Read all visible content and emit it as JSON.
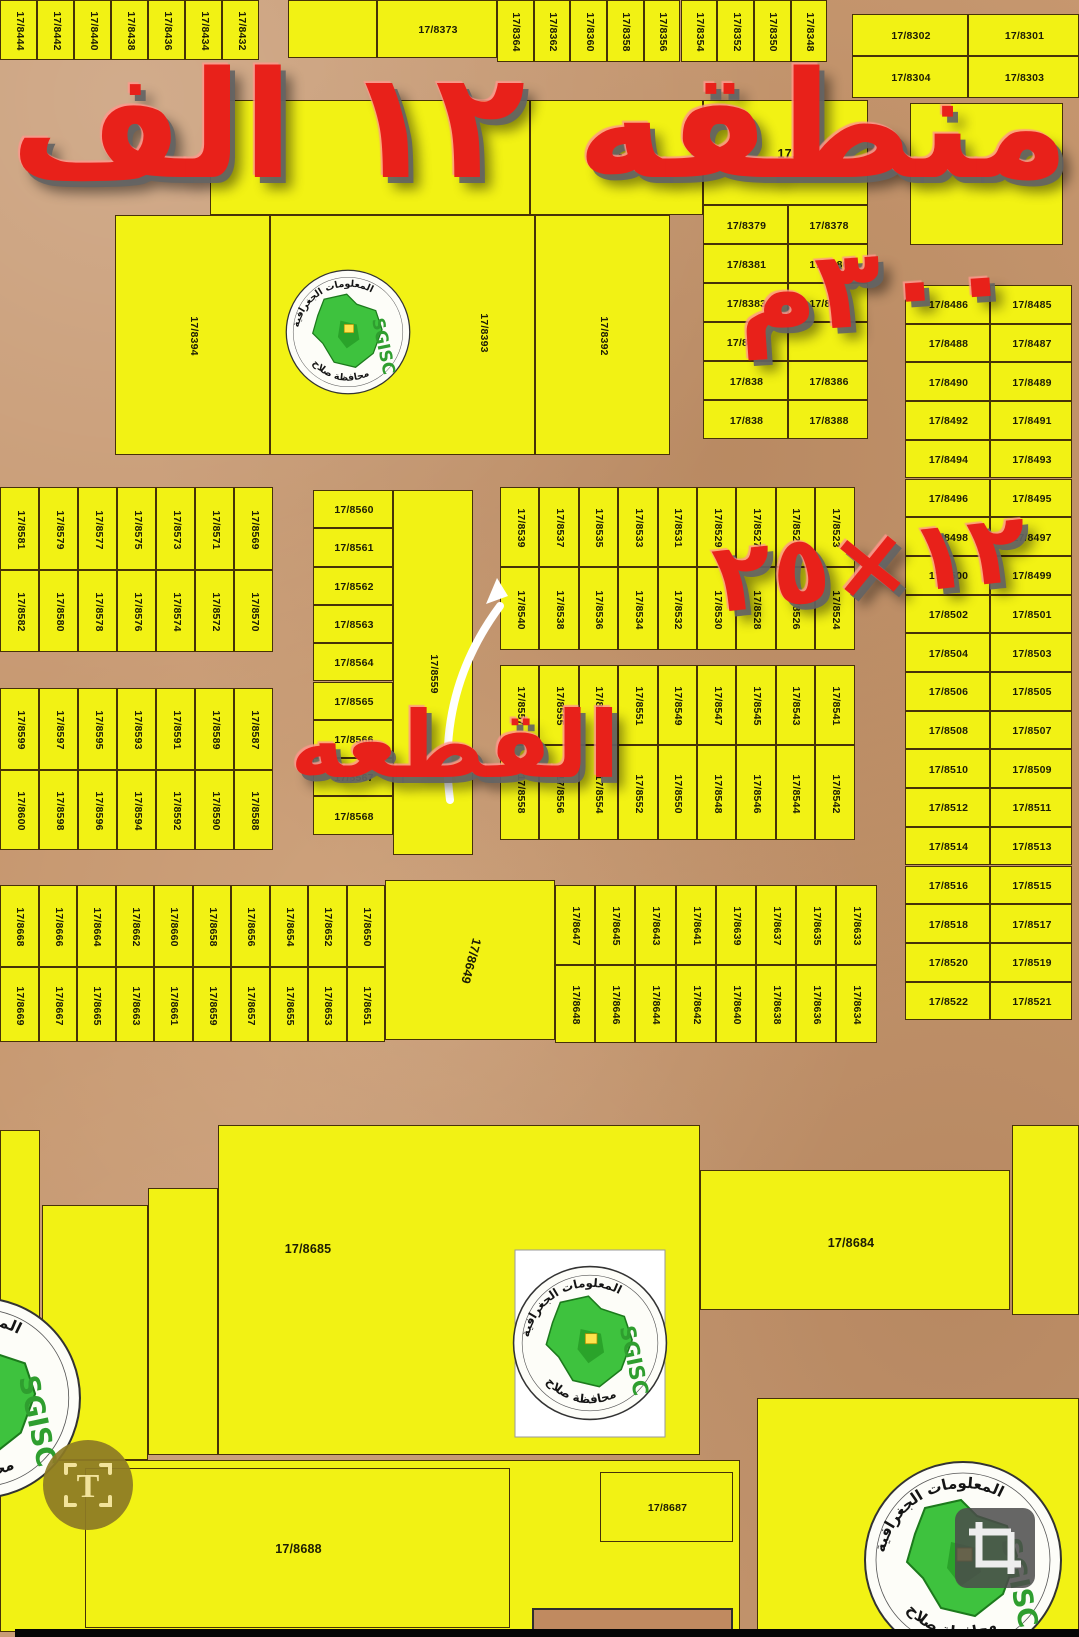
{
  "overlays": {
    "region_title": "منطقه ١٢ الف",
    "area_label": "٣٠٠م",
    "plot_size_label": "٢٥×١٢",
    "plot_callout": "القطعه"
  },
  "logo": {
    "name": "SGISC",
    "arc_top": "المعلومات الجغرافية",
    "arc_bottom": "محافظة صلاح"
  },
  "icons": {
    "t_label": "T"
  },
  "colors": {
    "plot_fill": "#f2f214",
    "road": "#c6976f",
    "overlay_red": "#e8211a",
    "logo_green": "#3ec23e"
  },
  "map": {
    "singles": [
      {
        "x": 288,
        "y": 0,
        "w": 89,
        "h": 58
      },
      {
        "l": "17/8373",
        "x": 377,
        "y": 0,
        "w": 120,
        "h": 58
      },
      {
        "x": 910,
        "y": 103,
        "w": 153,
        "h": 142
      },
      {
        "x": 210,
        "y": 100,
        "w": 320,
        "h": 115
      },
      {
        "l": "17.",
        "x": 530,
        "y": 100,
        "w": 173,
        "h": 115
      },
      {
        "l": "17.",
        "x": 703,
        "y": 100,
        "w": 165,
        "h": 105
      },
      {
        "l": "17/8394",
        "x": 115,
        "y": 215,
        "w": 155,
        "h": 240,
        "o": "v"
      },
      {
        "l": "17/8393",
        "x": 270,
        "y": 215,
        "w": 265,
        "h": 240,
        "o": "v",
        "lx": 483,
        "ly": 332
      },
      {
        "l": "17/8392",
        "x": 535,
        "y": 215,
        "w": 135,
        "h": 240,
        "o": "v"
      },
      {
        "l": "17/8559",
        "x": 393,
        "y": 490,
        "w": 80,
        "h": 365,
        "o": "v"
      },
      {
        "l": "17/8649",
        "x": 385,
        "y": 880,
        "w": 170,
        "h": 160,
        "o": "d"
      },
      {
        "l": "17/8685",
        "x": 218,
        "y": 1125,
        "w": 482,
        "h": 330,
        "lx": 307,
        "ly": 1248
      },
      {
        "x": 148,
        "y": 1188,
        "w": 70,
        "h": 267
      },
      {
        "l": "17/8684",
        "x": 700,
        "y": 1170,
        "w": 310,
        "h": 140,
        "lx": 850,
        "ly": 1242
      },
      {
        "x": 1012,
        "y": 1125,
        "w": 67,
        "h": 190
      },
      {
        "x": 42,
        "y": 1205,
        "w": 106,
        "h": 255
      },
      {
        "x": 0,
        "y": 1130,
        "w": 40,
        "h": 330
      },
      {
        "x": 0,
        "y": 1460,
        "w": 740,
        "h": 172
      },
      {
        "l": "17/8688",
        "x": 85,
        "y": 1468,
        "w": 425,
        "h": 160
      },
      {
        "l": "17/8687",
        "x": 600,
        "y": 1472,
        "w": 133,
        "h": 70
      },
      {
        "x": 757,
        "y": 1398,
        "w": 322,
        "h": 234
      },
      {
        "x": 532,
        "y": 1608,
        "w": 201,
        "h": 26,
        "fill": "road"
      }
    ],
    "strip_rows": [
      {
        "x": 0,
        "y": 0,
        "cw": 37,
        "h": 60,
        "labels": [
          "17/8444",
          "17/8442",
          "17/8440",
          "17/8438",
          "17/8436",
          "17/8434",
          "17/8432"
        ]
      },
      {
        "x": 497,
        "y": 0,
        "cw": 36.7,
        "h": 62,
        "labels": [
          "17/8364",
          "17/8362",
          "17/8360",
          "17/8358",
          "17/8356",
          "17/8354",
          "17/8352",
          "17/8350",
          "17/8348"
        ]
      },
      {
        "x": 0,
        "y": 487,
        "cw": 39,
        "h": 83,
        "labels": [
          "17/8581",
          "17/8579",
          "17/8577",
          "17/8575",
          "17/8573",
          "17/8571",
          "17/8569"
        ]
      },
      {
        "x": 0,
        "y": 570,
        "cw": 39,
        "h": 82,
        "labels": [
          "17/8582",
          "17/8580",
          "17/8578",
          "17/8576",
          "17/8574",
          "17/8572",
          "17/8570"
        ]
      },
      {
        "x": 0,
        "y": 688,
        "cw": 39,
        "h": 82,
        "labels": [
          "17/8599",
          "17/8597",
          "17/8595",
          "17/8593",
          "17/8591",
          "17/8589",
          "17/8587"
        ]
      },
      {
        "x": 0,
        "y": 770,
        "cw": 39,
        "h": 80,
        "labels": [
          "17/8600",
          "17/8598",
          "17/8596",
          "17/8594",
          "17/8592",
          "17/8590",
          "17/8588"
        ]
      },
      {
        "x": 500,
        "y": 487,
        "cw": 39.4,
        "h": 80,
        "labels": [
          "17/8539",
          "17/8537",
          "17/8535",
          "17/8533",
          "17/8531",
          "17/8529",
          "17/8527",
          "17/8525",
          "17/8523"
        ]
      },
      {
        "x": 500,
        "y": 567,
        "cw": 39.4,
        "h": 83,
        "labels": [
          "17/8540",
          "17/8538",
          "17/8536",
          "17/8534",
          "17/8532",
          "17/8530",
          "17/8528",
          "17/8526",
          "17/8524"
        ]
      },
      {
        "x": 500,
        "y": 665,
        "cw": 39.4,
        "h": 80,
        "labels": [
          "17/8557",
          "17/8555",
          "17/8553",
          "17/8551",
          "17/8549",
          "17/8547",
          "17/8545",
          "17/8543",
          "17/8541"
        ]
      },
      {
        "x": 500,
        "y": 745,
        "cw": 39.4,
        "h": 95,
        "labels": [
          "17/8558",
          "17/8556",
          "17/8554",
          "17/8552",
          "17/8550",
          "17/8548",
          "17/8546",
          "17/8544",
          "17/8542"
        ]
      },
      {
        "x": 0,
        "y": 885,
        "cw": 38.5,
        "h": 82,
        "labels": [
          "17/8668",
          "17/8666",
          "17/8664",
          "17/8662",
          "17/8660",
          "17/8658",
          "17/8656",
          "17/8654",
          "17/8652",
          "17/8650"
        ]
      },
      {
        "x": 0,
        "y": 967,
        "cw": 38.5,
        "h": 75,
        "labels": [
          "17/8669",
          "17/8667",
          "17/8665",
          "17/8663",
          "17/8661",
          "17/8659",
          "17/8657",
          "17/8655",
          "17/8653",
          "17/8651"
        ]
      },
      {
        "x": 555,
        "y": 885,
        "cw": 40.2,
        "h": 80,
        "labels": [
          "17/8647",
          "17/8645",
          "17/8643",
          "17/8641",
          "17/8639",
          "17/8637",
          "17/8635",
          "17/8633"
        ]
      },
      {
        "x": 555,
        "y": 965,
        "cw": 40.2,
        "h": 78,
        "labels": [
          "17/8648",
          "17/8646",
          "17/8644",
          "17/8642",
          "17/8640",
          "17/8638",
          "17/8636",
          "17/8634"
        ]
      }
    ],
    "grids": [
      {
        "x": 852,
        "y": 14,
        "cws": [
          116,
          111
        ],
        "rh": 42,
        "rows": [
          [
            "17/8302",
            "17/8301"
          ],
          [
            "17/8304",
            "17/8303"
          ]
        ]
      },
      {
        "x": 703,
        "y": 205,
        "cws": [
          85,
          80
        ],
        "rh": 39,
        "rows": [
          [
            "17/8379",
            "17/8378"
          ],
          [
            "17/8381",
            "17/8380"
          ],
          [
            "17/8383",
            "17/8382"
          ],
          [
            "17/8385",
            ""
          ],
          [
            "17/838",
            "17/8386"
          ],
          [
            "17/838",
            "17/8388"
          ]
        ]
      },
      {
        "x": 905,
        "y": 285,
        "cws": [
          85,
          82
        ],
        "rh": 38.7,
        "rows": [
          [
            "17/8486",
            "17/8485"
          ],
          [
            "17/8488",
            "17/8487"
          ],
          [
            "17/8490",
            "17/8489"
          ],
          [
            "17/8492",
            "17/8491"
          ],
          [
            "17/8494",
            "17/8493"
          ],
          [
            "17/8496",
            "17/8495"
          ],
          [
            "17/8498",
            "17/8497"
          ],
          [
            "17/8500",
            "17/8499"
          ],
          [
            "17/8502",
            "17/8501"
          ],
          [
            "17/8504",
            "17/8503"
          ],
          [
            "17/8506",
            "17/8505"
          ],
          [
            "17/8508",
            "17/8507"
          ],
          [
            "17/8510",
            "17/8509"
          ],
          [
            "17/8512",
            "17/8511"
          ],
          [
            "17/8514",
            "17/8513"
          ],
          [
            "17/8516",
            "17/8515"
          ],
          [
            "17/8518",
            "17/8517"
          ],
          [
            "17/8520",
            "17/8519"
          ],
          [
            "17/8522",
            "17/8521"
          ]
        ]
      },
      {
        "x": 313,
        "y": 490,
        "cws": [
          80
        ],
        "rh": 38.3,
        "rows": [
          [
            "17/8560"
          ],
          [
            "17/8561"
          ],
          [
            "17/8562"
          ],
          [
            "17/8563"
          ],
          [
            "17/8564"
          ],
          [
            "17/8565"
          ],
          [
            "17/8566"
          ],
          [
            "17/8567"
          ],
          [
            "17/8568"
          ]
        ]
      }
    ]
  }
}
